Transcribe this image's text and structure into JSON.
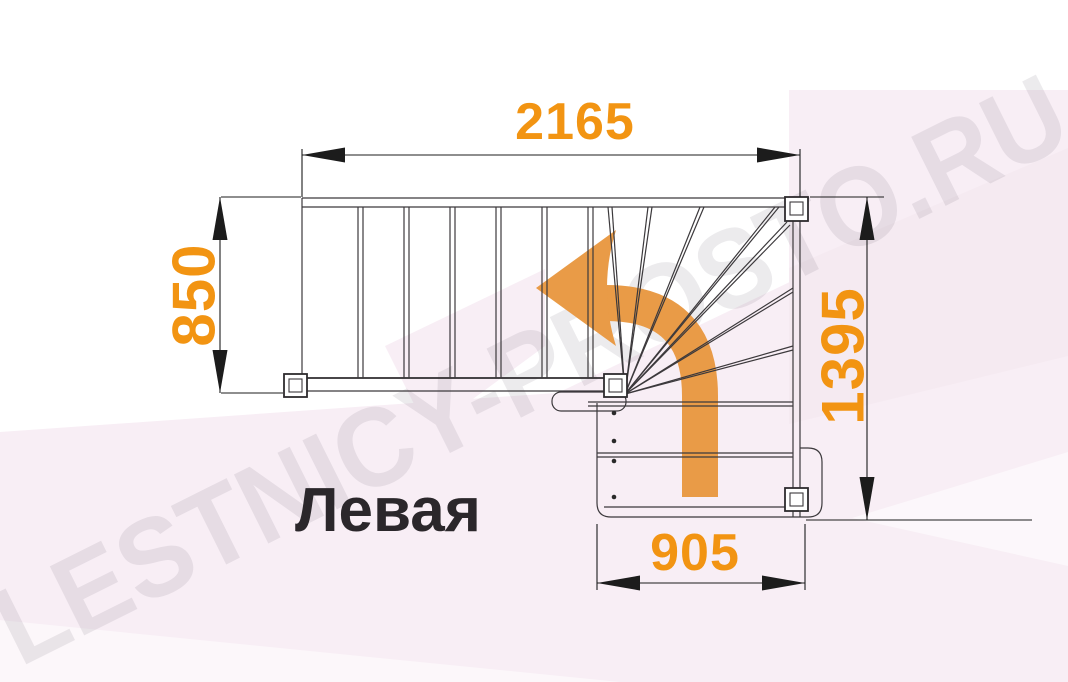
{
  "watermark": "LESTNICY-PROSTO.RU",
  "stair_label": "Левая",
  "dimensions": {
    "top_width": "2165",
    "left_depth": "850",
    "right_height": "1395",
    "bottom_width": "905"
  },
  "icons": {
    "direction_arrow": "curved-turn-left-arrow"
  },
  "colors": {
    "dimension_text": "#F29412",
    "arrow_orange": "#E99B47",
    "drawing_line": "#3C393C",
    "dimension_line": "#1C1C1C",
    "label_text": "#2B272B",
    "background_pink": "#F8EEF5",
    "background_pink_dark": "#F2E2EC",
    "watermark_gray": "#6F6575"
  }
}
